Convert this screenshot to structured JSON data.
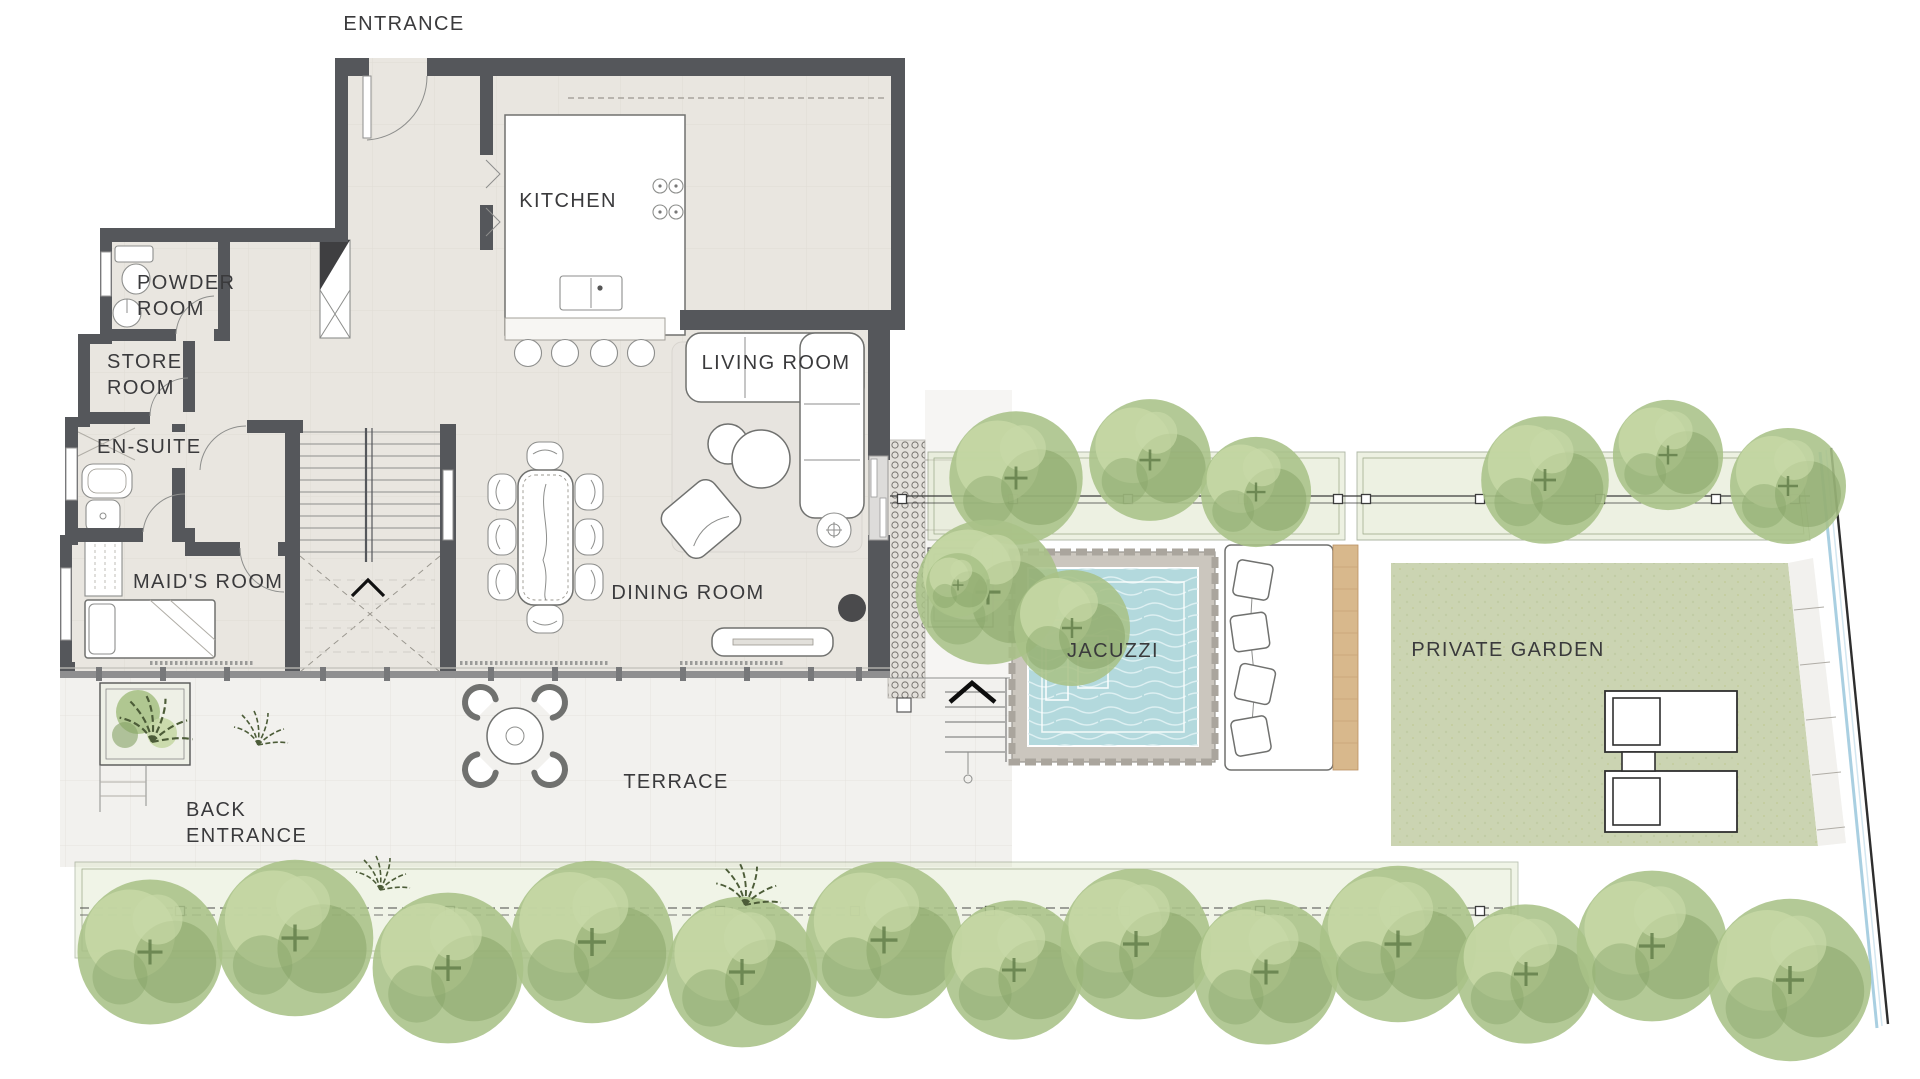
{
  "plan": {
    "title": "Villa ground floor plan with terrace, jacuzzi and private garden",
    "labels": {
      "entrance": "ENTRANCE",
      "kitchen": "KITCHEN",
      "powder_room": "POWDER\nROOM",
      "store_room": "STORE\nROOM",
      "en_suite": "EN-SUITE",
      "maids_room": "MAID'S ROOM",
      "living_room": "LIVING ROOM",
      "dining_room": "DINING ROOM",
      "terrace": "TERRACE",
      "back_entrance": "BACK\nENTRANCE",
      "jacuzzi": "JACUZZI",
      "private_garden": "PRIVATE GARDEN"
    }
  },
  "colors": {
    "wall": "#55575b",
    "floor": "#e9e6e0",
    "terrace": "#f2f1ee",
    "lawn": "#cbd4b2",
    "water": "#b3d9dd",
    "wood": "#d8b88c",
    "hedge": "#dfe7cc",
    "tree_base": "#a9c287",
    "tree_light": "#c7d8a6",
    "tree_dark": "#85a266",
    "label": "#3a3a3c",
    "furniture_stroke": "#70716f",
    "boundary_blue": "#a5cde0"
  }
}
